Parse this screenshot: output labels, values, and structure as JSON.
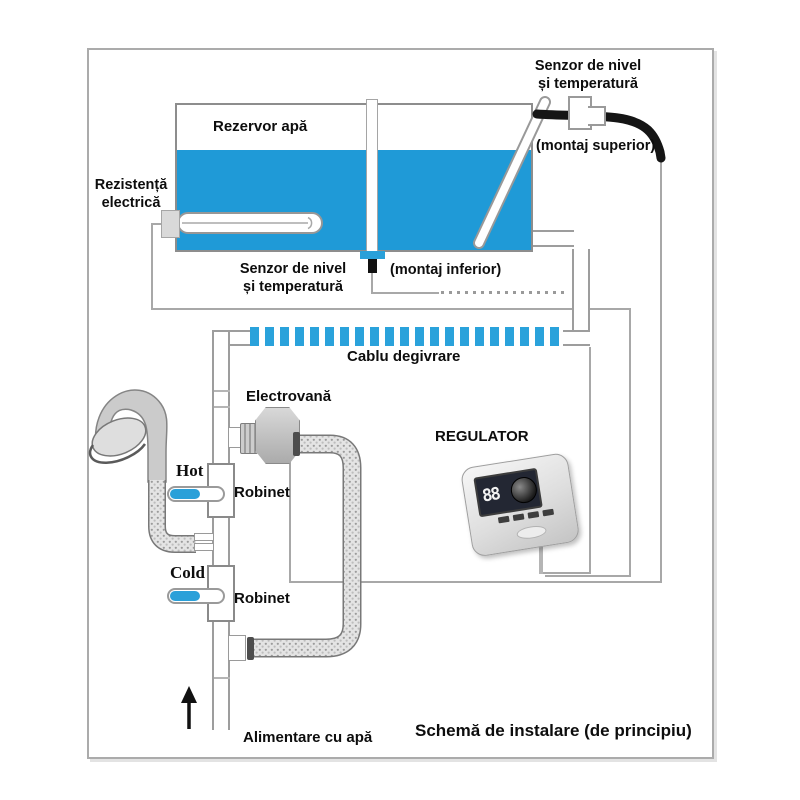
{
  "title": "Schemă de instalare (de principiu)",
  "colors": {
    "water_blue": "#1f9ad7",
    "defrost_strip_blue": "#2aa2db",
    "tap_blue": "#2aa0d9",
    "cable_black": "#151515",
    "wire_gray": "#a8a8a8",
    "border_gray": "#ababab"
  },
  "tank": {
    "label": "Rezervor apă"
  },
  "sensors": {
    "top_line1": "Senzor de nivel",
    "top_line2": "și temperatură",
    "top_mount": "(montaj superior)",
    "bottom_line1": "Senzor de nivel",
    "bottom_line2": "și temperatură",
    "bottom_mount": "(montaj inferior)"
  },
  "heater": {
    "line1": "Rezistență",
    "line2": "electrică"
  },
  "defrost_cable": {
    "label": "Cablu degivrare"
  },
  "valve": {
    "label": "Electrovană"
  },
  "regulator": {
    "label": "REGULATOR",
    "display_digits": "88"
  },
  "taps": {
    "hot": "Hot",
    "hot_valve": "Robinet",
    "cold": "Cold",
    "cold_valve": "Robinet"
  },
  "supply": {
    "label": "Alimentare cu apă"
  }
}
